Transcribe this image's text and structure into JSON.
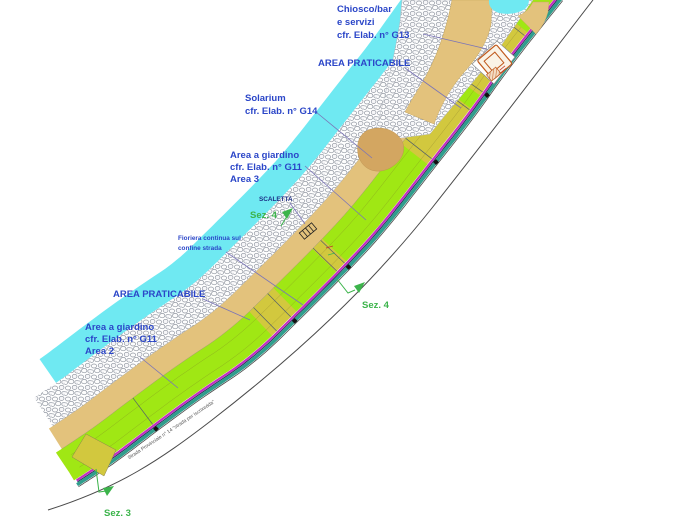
{
  "title": "Coastal site plan",
  "annotations": {
    "chiosco": {
      "lines": [
        "Chiosco/bar",
        "e servizi",
        "cfr. Elab. n° G13"
      ]
    },
    "area_praticabile_top": "AREA PRATICABILE",
    "solarium": {
      "lines": [
        "Solarium",
        "cfr. Elab. n° G14"
      ]
    },
    "area_giardino_3": {
      "lines": [
        "Area a giardino",
        "cfr. Elab. n° G11",
        "Area 3"
      ]
    },
    "scaletta": "SCALETTA",
    "fioriera": {
      "lines": [
        "Fioriera continua sul",
        "confine strada"
      ]
    },
    "area_praticabile_bottom": "AREA PRATICABILE",
    "area_giardino_2": {
      "lines": [
        "Area a giardino",
        "cfr. Elab. n° G11",
        "Area 2"
      ]
    },
    "sez4_upper": "Sez. 4",
    "sez4_lower": "Sez. 4",
    "sez3": "Sez. 3",
    "road_name": "Strada Provinciale n° 14 \"strada per Iscrixedda\""
  },
  "colors": {
    "water": "#6FE9F2",
    "sand": "#E3C27C",
    "sand_dark": "#D3A661",
    "khaki": "#D2C83E",
    "lime": "#A0E714",
    "magenta": "#C32FC3",
    "teal": "#2F9E8C",
    "navy_line": "#232355",
    "road_edge": "#4a4a4a",
    "stone_outline": "#9298a2",
    "label_blue": "#2b46c8",
    "label_navy": "#1c2f86",
    "leader": "#7a74b8",
    "section_green": "#3cb44b",
    "road_text": "#555555",
    "kiosk_orange": "#c05a1e",
    "marker_black": "#111111"
  }
}
